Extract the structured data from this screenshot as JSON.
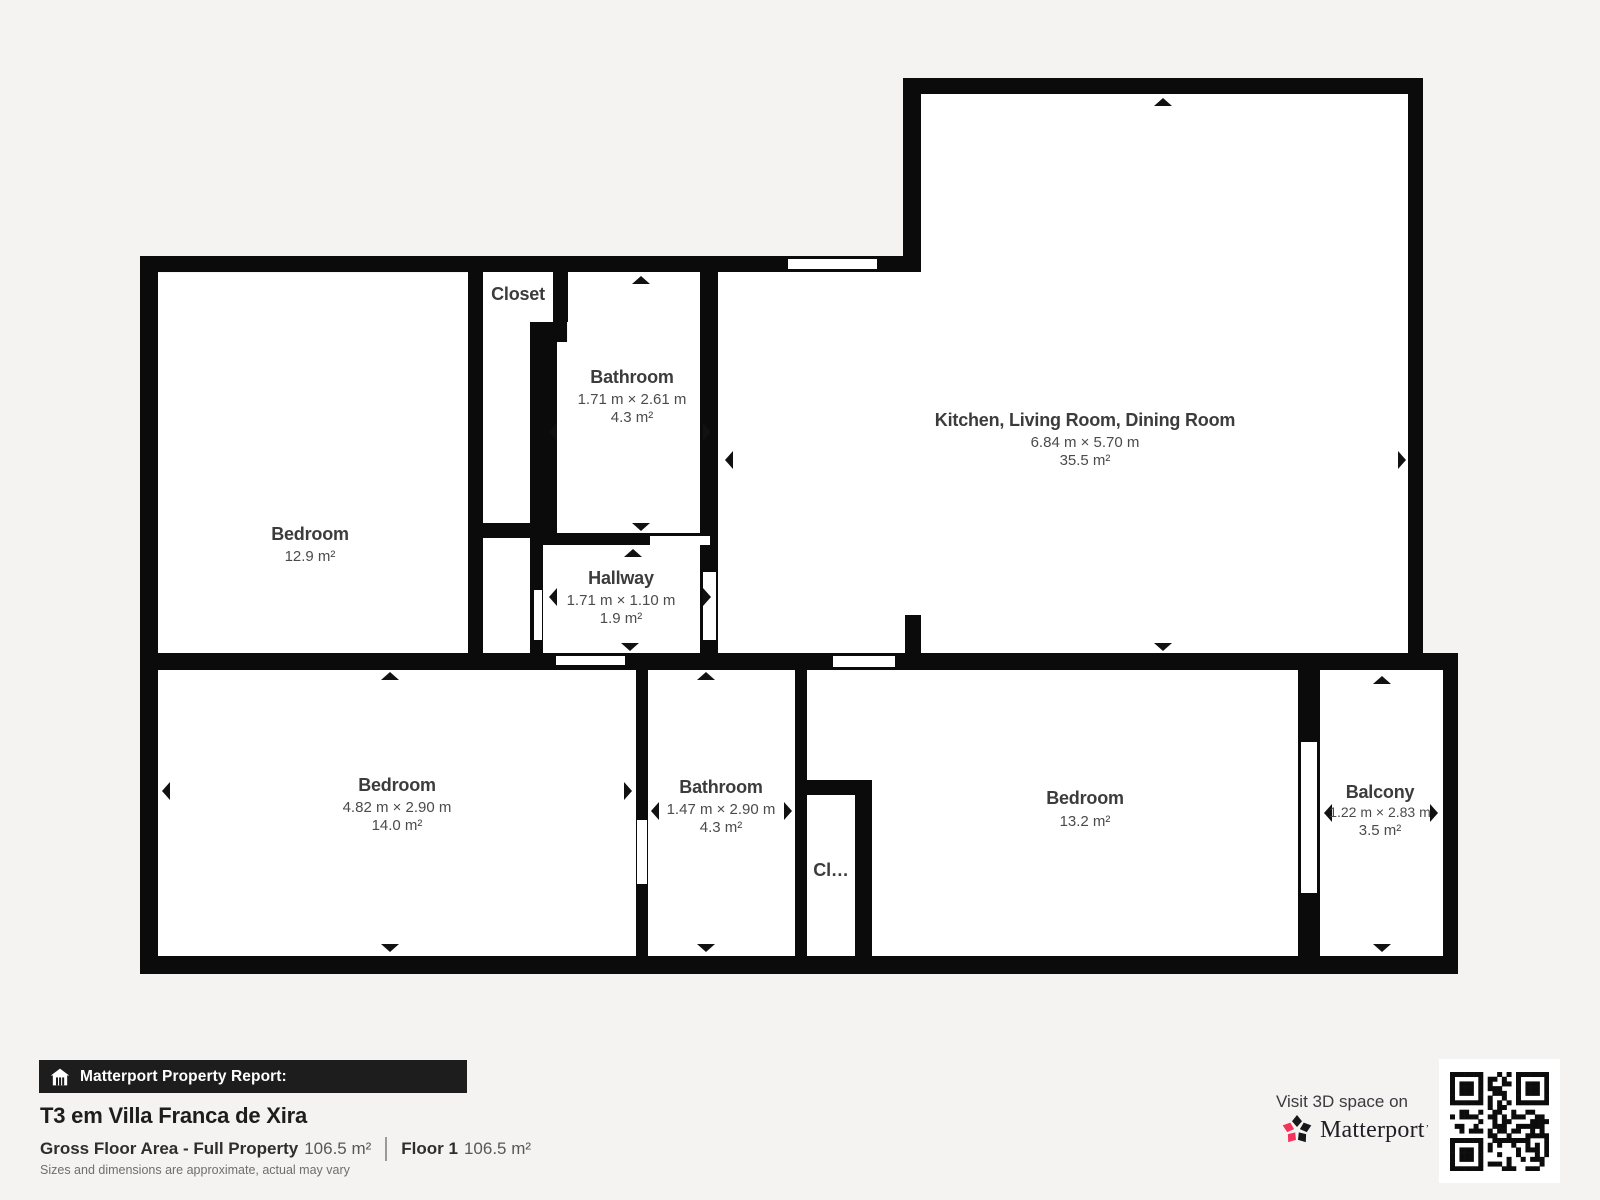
{
  "plan": {
    "rooms": [
      {
        "name": "Bedroom",
        "dims": "",
        "area": "12.9 m²"
      },
      {
        "name": "Closet",
        "dims": "",
        "area": ""
      },
      {
        "name": "Bathroom",
        "dims": "1.71 m × 2.61 m",
        "area": "4.3 m²"
      },
      {
        "name": "Hallway",
        "dims": "1.71 m × 1.10 m",
        "area": "1.9 m²"
      },
      {
        "name": "Kitchen, Living Room, Dining Room",
        "dims": "6.84 m × 5.70 m",
        "area": "35.5 m²"
      },
      {
        "name": "Bedroom",
        "dims": "4.82 m × 2.90 m",
        "area": "14.0 m²"
      },
      {
        "name": "Bathroom",
        "dims": "1.47 m × 2.90 m",
        "area": "4.3 m²"
      },
      {
        "name": "Cl…",
        "dims": "",
        "area": ""
      },
      {
        "name": "Bedroom",
        "dims": "",
        "area": "13.2 m²"
      },
      {
        "name": "Balcony",
        "dims": "1.22 m × 2.83 m",
        "area": "3.5 m²"
      }
    ]
  },
  "footer": {
    "report_label": "Matterport Property Report:",
    "title": "T3 em Villa Franca de Xira",
    "gfa_label": "Gross Floor Area - Full Property",
    "gfa_value": "106.5 m²",
    "floor_label": "Floor 1",
    "floor_value": "106.5 m²",
    "disclaimer": "Sizes and dimensions are approximate, actual may vary"
  },
  "cta": {
    "visit_text": "Visit 3D space on",
    "brand": "Matterport",
    "brand_mark": "’"
  },
  "colors": {
    "background": "#f4f3f1",
    "wall": "#0b0b0b",
    "room": "#ffffff",
    "brand_pink": "#f5325b",
    "brand_black": "#17181c"
  }
}
